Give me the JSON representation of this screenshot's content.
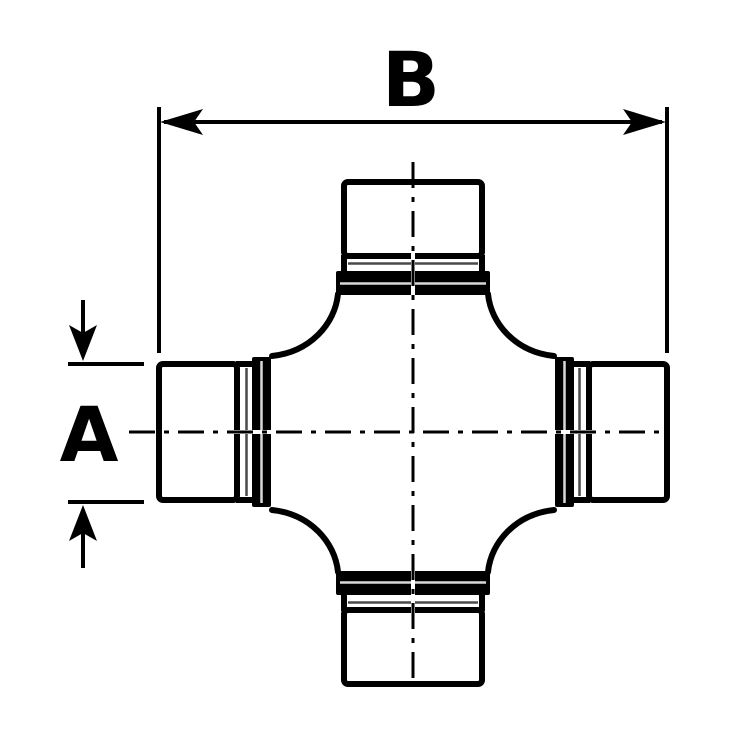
{
  "figure": {
    "type_name": "universal-joint-cross-technical-drawing",
    "dimension_labels": {
      "a": "A",
      "b": "B"
    }
  },
  "colors": {
    "ink": "#000000",
    "background": "#ffffff",
    "thin_line": "#4a4a4a",
    "groove_highlight": "#d9d9d9"
  }
}
